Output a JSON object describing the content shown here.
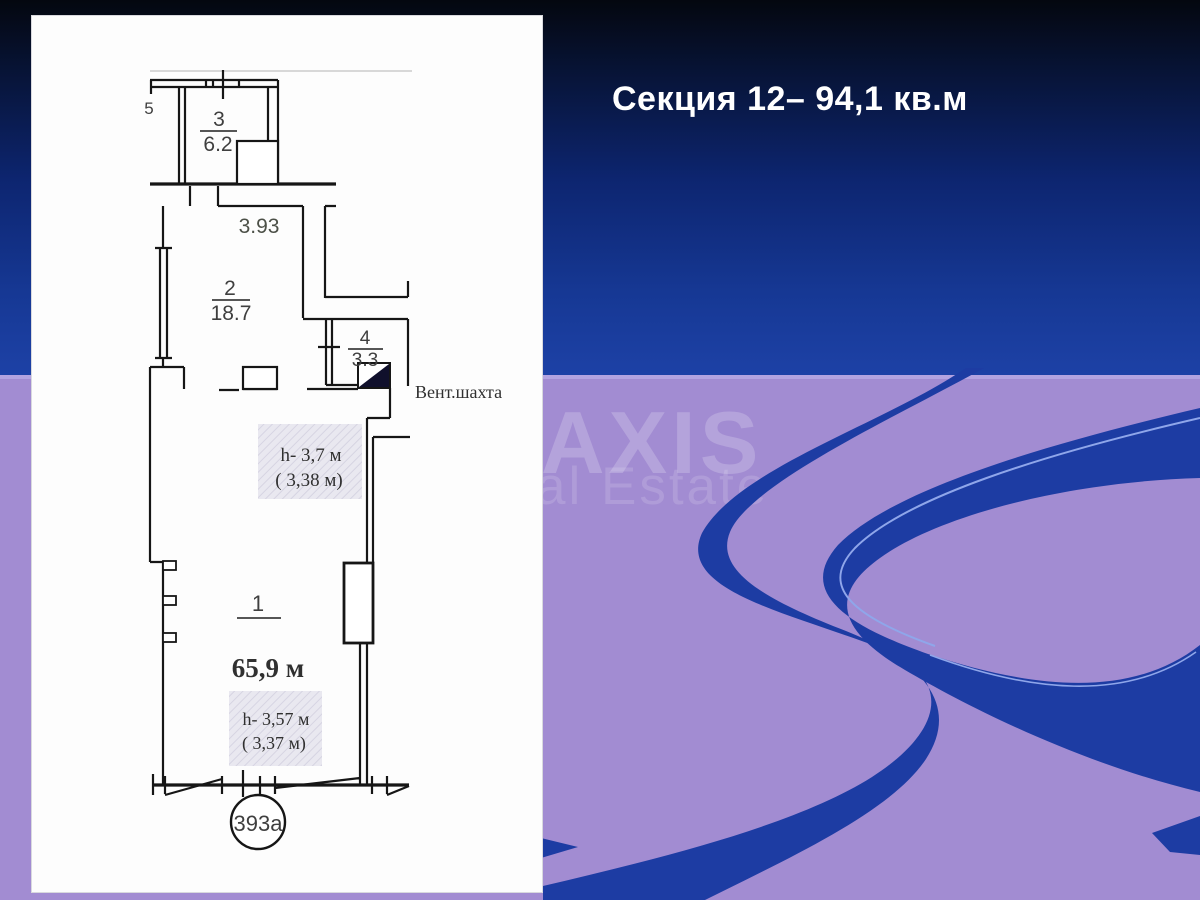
{
  "title": "Секция 12– 94,1 кв.м",
  "watermark": {
    "line1": "AXIS",
    "line2": "al Estate"
  },
  "plan": {
    "partial_dim": "5",
    "top_dim": "3.93",
    "room3": {
      "num": "3",
      "area": "6.2"
    },
    "room2": {
      "num": "2",
      "area": "18.7"
    },
    "room4": {
      "num": "4",
      "area": "3.3"
    },
    "room1": {
      "num": "1",
      "area": "65,9 м"
    },
    "vent_label": "Вент.шахта",
    "height_note_upper": {
      "line1": "h- 3,7 м",
      "line2": "( 3,38 м)"
    },
    "height_note_lower": {
      "line1": "h- 3,57 м",
      "line2": "( 3,37 м)"
    },
    "unit_number": "393а"
  },
  "colors": {
    "accent_blue": "#1d3ca3",
    "background_purple": "#a28cd2",
    "title_color": "#ffffff"
  }
}
